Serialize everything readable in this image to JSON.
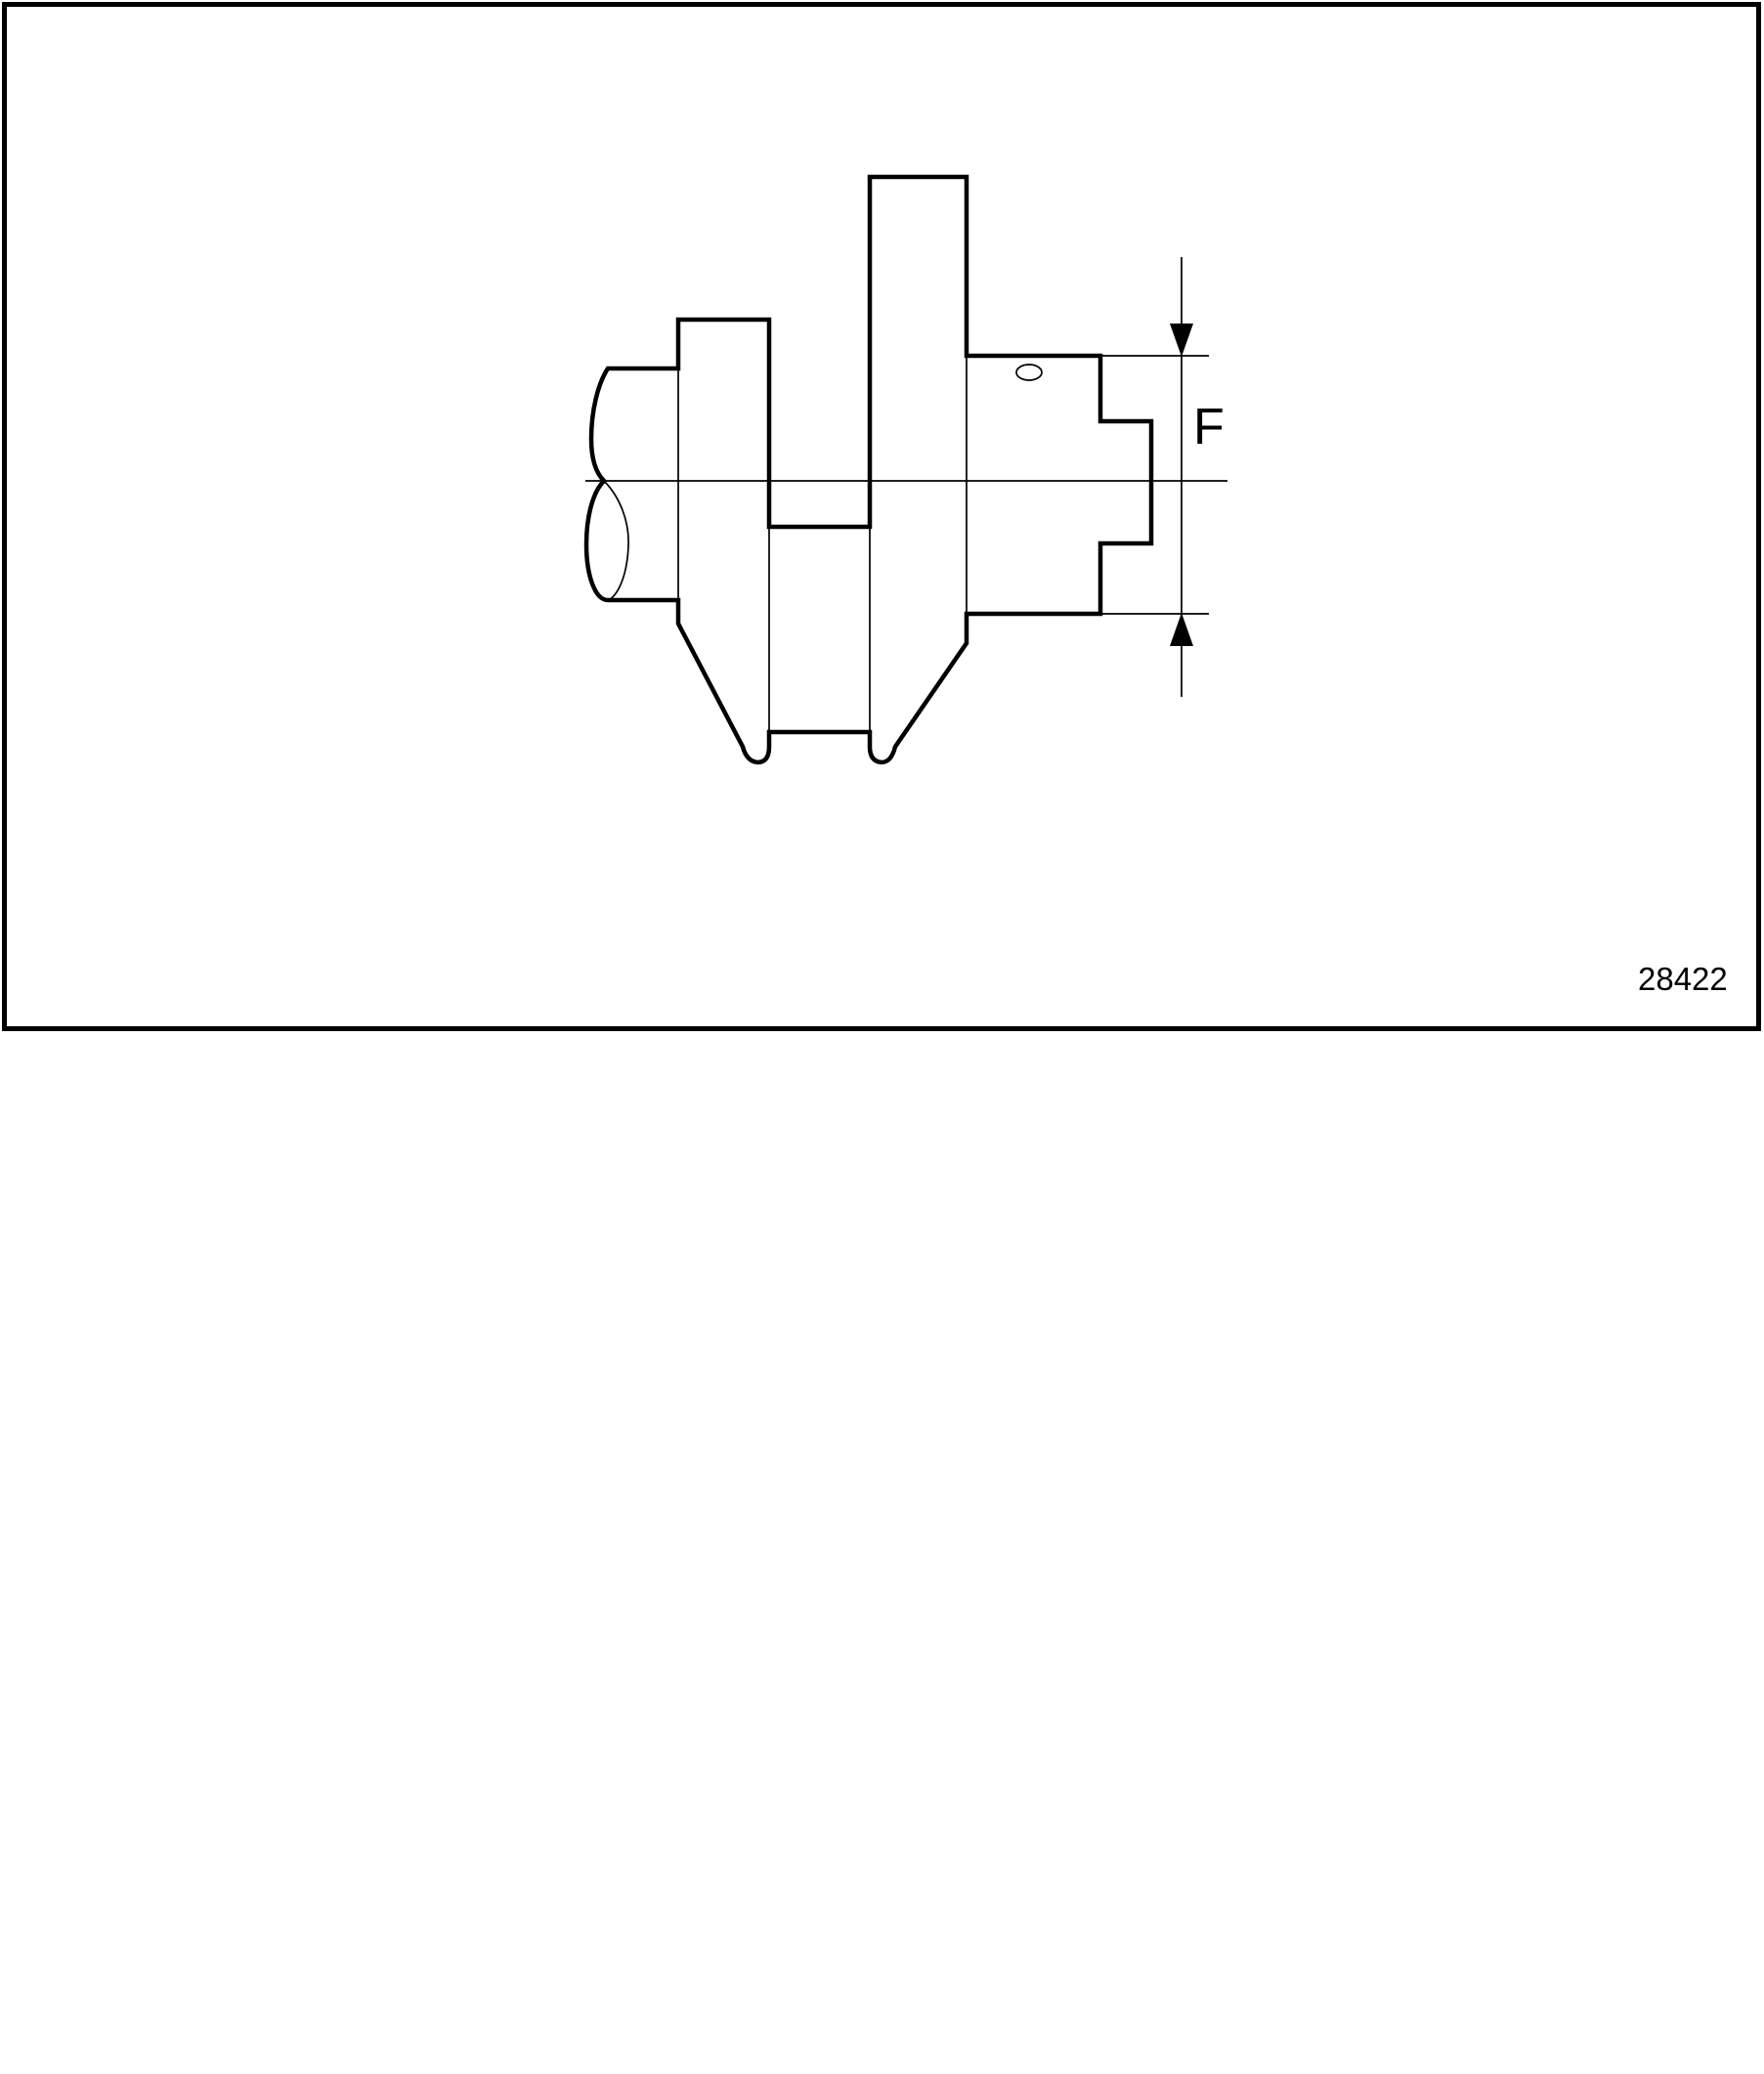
{
  "figure": {
    "dimension_label": "F",
    "figure_number": "28422",
    "description": "crankshaft-section-with-journal-diameter-dimension"
  },
  "icons": {
    "dimension_arrow_top": "filled-triangle-down",
    "dimension_arrow_bottom": "filled-triangle-up"
  },
  "colors": {
    "line": "#000000",
    "background": "#ffffff"
  }
}
